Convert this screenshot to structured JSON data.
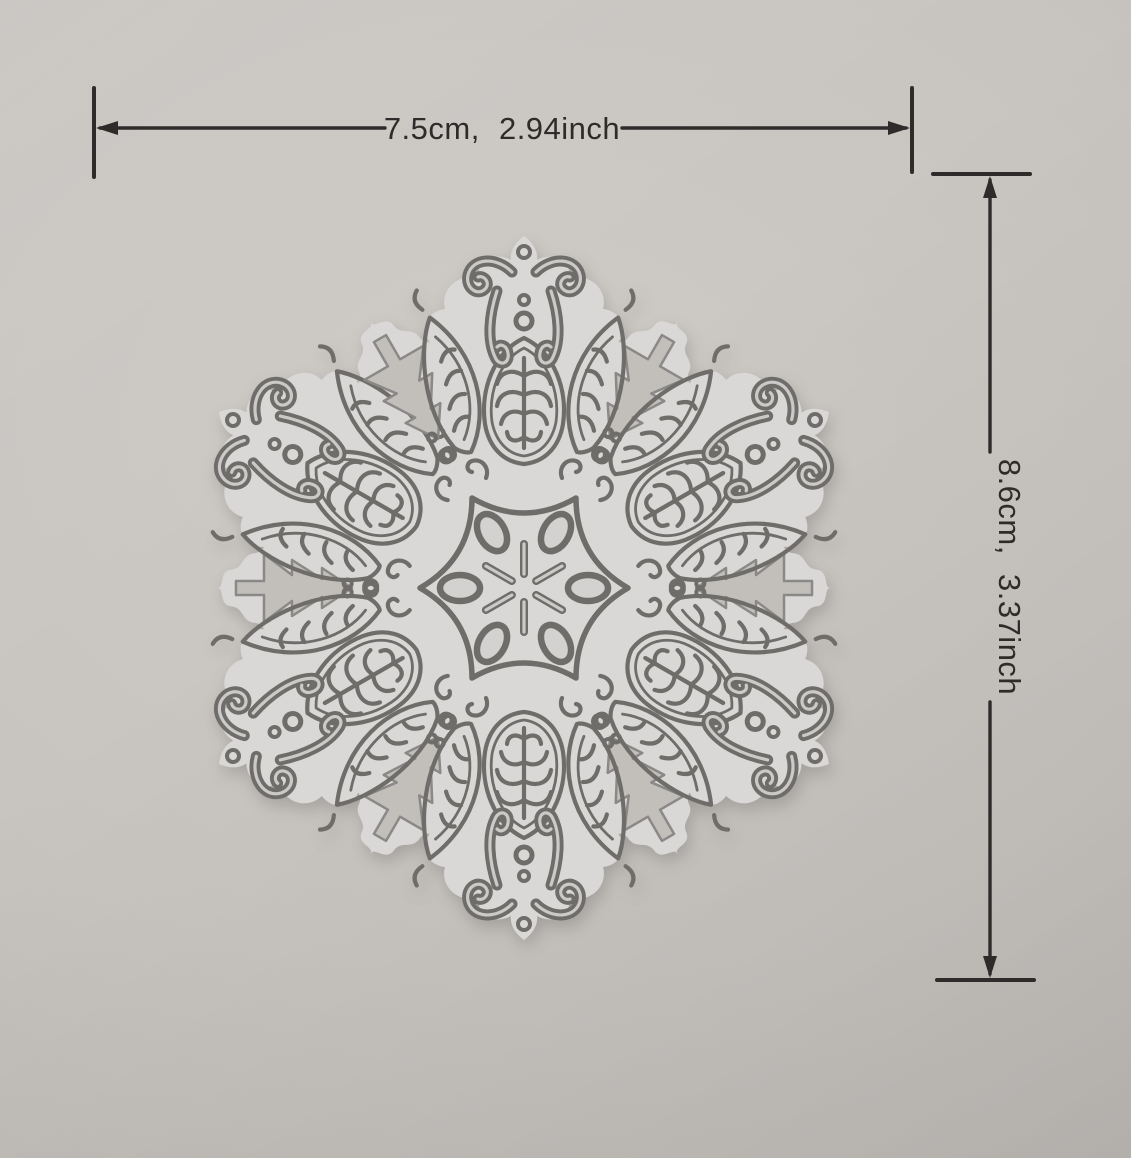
{
  "photo": {
    "subject": "snowflake metal cutting die",
    "colors": {
      "background": "#c8c4c0",
      "die": "#d9d8d6",
      "engraving": "#6e6d6b",
      "cutout_hole": "#c2bfbb",
      "annotation": "#2e2c2a"
    }
  },
  "annotations": {
    "width_label": "7.5cm, 2.94inch",
    "height_label": "8.6cm, 3.37inch"
  }
}
